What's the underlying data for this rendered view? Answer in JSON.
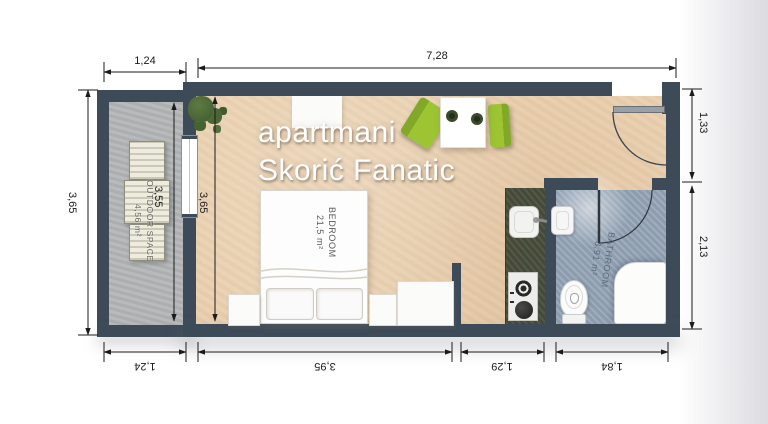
{
  "title": {
    "line1": "apartmani",
    "line2": "Skorić Fanatic"
  },
  "rooms": {
    "bedroom": {
      "name": "BEDROOM",
      "area": "21,5 m²"
    },
    "bathroom": {
      "name": "BATHROOM",
      "area": "3,91 m²"
    },
    "outdoor_space": {
      "name": "OUTDOOR SPACE",
      "area": "4,56 m²"
    }
  },
  "dimensions": {
    "top_balcony_width": "1,24",
    "top_main_width": "7,28",
    "left_outer_height": "3,65",
    "balcony_inner_height": "3,55",
    "bedroom_inner_height": "3,65",
    "right_entry_height": "1,33",
    "right_bathroom_height": "2,13",
    "bottom_balcony_width": "1,24",
    "bottom_bedroom_width": "3,95",
    "bottom_kitchen_width": "1,29",
    "bottom_bathroom_width": "1,84"
  },
  "colors": {
    "wall": "#3d4b59",
    "room_floor": "#e9cfae",
    "balcony_floor": "#b2b4b5",
    "bathroom_floor": "#94a4b6",
    "kitchen_counter": "#4a4f3d",
    "chair_green": "#9dc433",
    "dimension_text": "#1b1b1b"
  }
}
